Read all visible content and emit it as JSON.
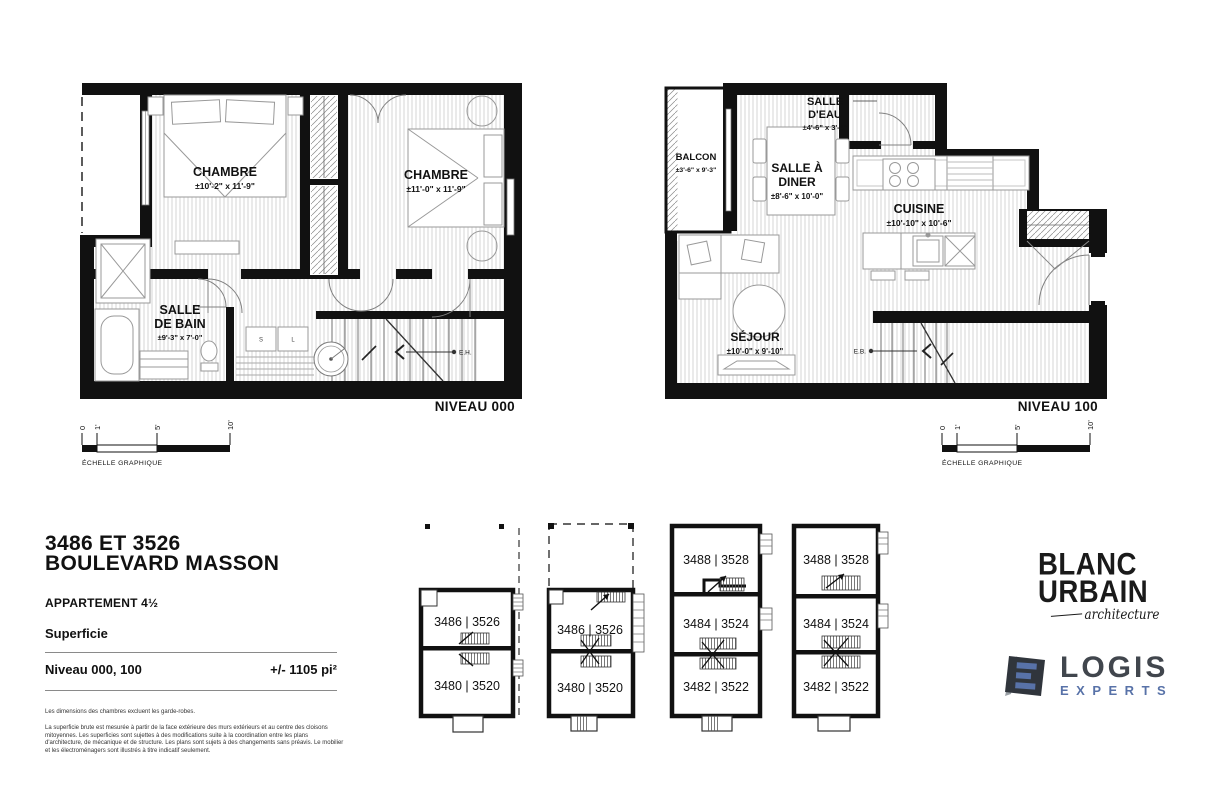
{
  "plan_left": {
    "niveau_label": "NIVEAU 000",
    "chambre1_name": "CHAMBRE",
    "chambre1_dims": "±10'-2\" x 11'-9\"",
    "chambre2_name": "CHAMBRE",
    "chambre2_dims": "±11'-0\" x 11'-9\"",
    "bain_name1": "SALLE",
    "bain_name2": "DE BAIN",
    "bain_dims": "±9'-3\" x 7'-0\"",
    "stair_label": "E.H.",
    "appliance_s": "S",
    "appliance_l": "L"
  },
  "plan_right": {
    "niveau_label": "NIVEAU 100",
    "balcon_name": "BALCON",
    "balcon_dims": "±3'-6\" x 9'-3\"",
    "eau_name1": "SALLE",
    "eau_name2": "D'EAU",
    "eau_dims": "±4'-6\" x 3'-6\"",
    "diner_name1": "SALLE À",
    "diner_name2": "DINER",
    "diner_dims": "±8'-6\" x 10'-0\"",
    "cuisine_name": "CUISINE",
    "cuisine_dims": "±10'-10\" x 10'-6\"",
    "sejour_name": "SÉJOUR",
    "sejour_dims": "±10'-0\" x 9'-10\"",
    "stair_label": "E.B."
  },
  "scale_bar": {
    "tick0": "0",
    "tick1": "1'",
    "tick5": "5'",
    "tick10": "10'",
    "caption": "ÉCHELLE GRAPHIQUE"
  },
  "title_block": {
    "address1": "3486 ET 3526",
    "address2": "BOULEVARD MASSON",
    "apartment": "APPARTEMENT 4½",
    "superficie": "Superficie",
    "niveau_row_label": "Niveau 000, 100",
    "area": "+/- 1105 pi²",
    "note1": "Les dimensions des chambres excluent les garde-robes.",
    "note2": "La superficie brute est mesurée à partir de la face extérieure des murs extérieurs et au centre des cloisons mitoyennes. Les superficies sont sujettes à des modifications suite à la coordination entre les plans d'architecture, de mécanique et de structure. Les plans sont sujets à des changements sans préavis. Le mobilier et les électroménagers sont illustrés à titre indicatif seulement."
  },
  "key_plans": {
    "b1_top": "3486 | 3526",
    "b1_bottom": "3480 | 3520",
    "b2_top": "3486 | 3526",
    "b2_bottom": "3480 | 3520",
    "b3_top": "3488 | 3528",
    "b3_mid": "3484 | 3524",
    "b3_bottom": "3482 | 3522",
    "b4_top": "3488 | 3528",
    "b4_mid": "3484 | 3524",
    "b4_bottom": "3482 | 3522"
  },
  "logos": {
    "blanc1": "BLANC",
    "blanc2": "URBAIN",
    "blanc_tagline": "architecture",
    "logis_word": "LOGIS",
    "experts_word": "EXPERTS"
  },
  "colors": {
    "wall": "#111111",
    "floor_line": "#d6d6d6",
    "furniture_line": "#999999",
    "logis_dark": "#41464d",
    "logis_blue": "#5872a8"
  }
}
